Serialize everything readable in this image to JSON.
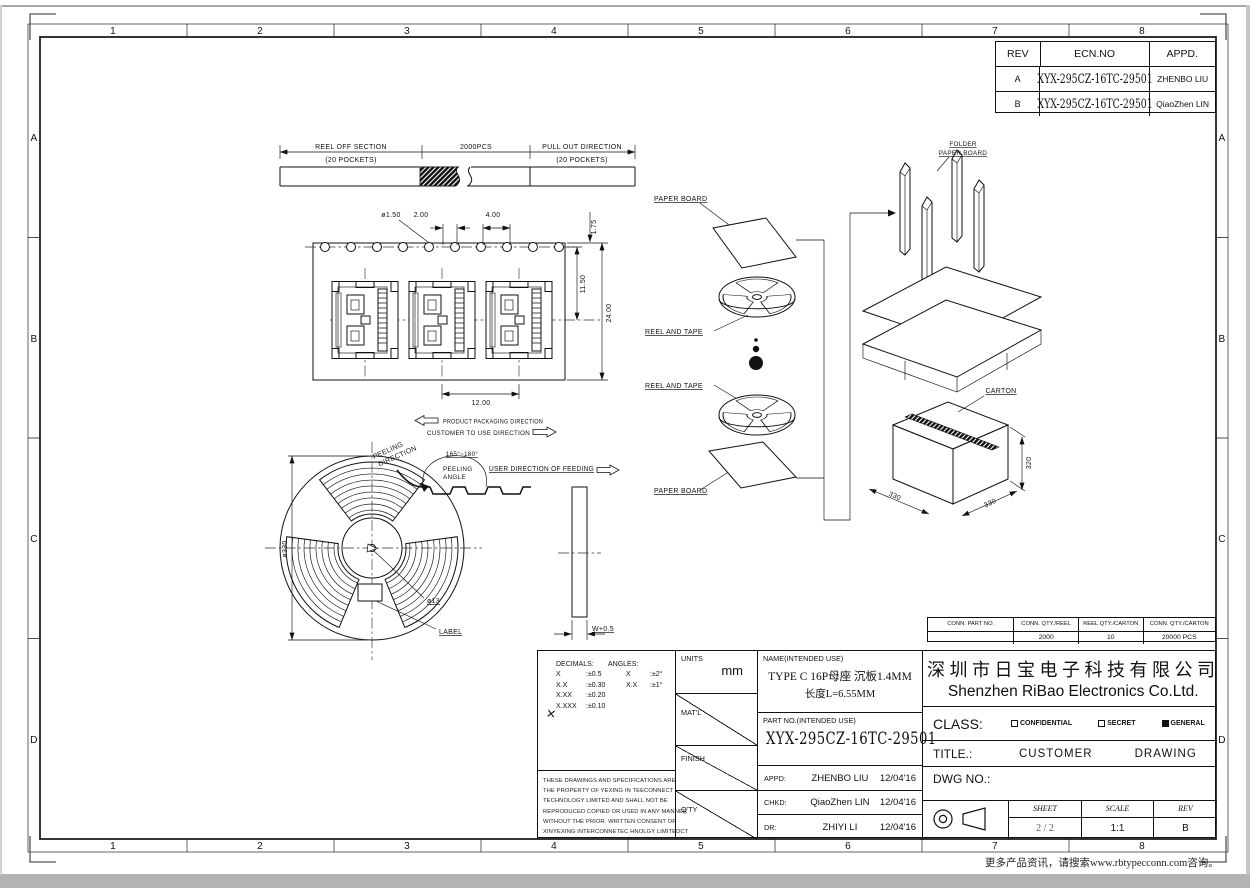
{
  "zones": {
    "top": [
      "1",
      "2",
      "3",
      "4",
      "5",
      "6",
      "7",
      "8"
    ],
    "bottom": [
      "1",
      "2",
      "3",
      "4",
      "5",
      "6",
      "7",
      "8"
    ],
    "left": [
      "A",
      "B",
      "C",
      "D"
    ],
    "right": [
      "A",
      "B",
      "C",
      "D"
    ]
  },
  "rev_table": {
    "h_rev": "REV",
    "h_ecn": "ECN.NO",
    "h_appd": "APPD.",
    "rows": [
      {
        "rev": "A",
        "ecn": "XYX-295CZ-16TC-29501",
        "appd": "ZHENBO LIU"
      },
      {
        "rev": "B",
        "ecn": "XYX-295CZ-16TC-29501",
        "appd": "QiaoZhen LIN"
      }
    ]
  },
  "strip": {
    "left_title": "REEL OFF SECTION",
    "left_sub": "(20 POCKETS)",
    "mid": "2000PCS",
    "right_title": "PULL OUT DIRECTION",
    "right_sub": "(20 POCKETS)"
  },
  "tape": {
    "dia_hole": "ø1.50",
    "dim_2": "2.00",
    "dim_4": "4.00",
    "dim_175": "1.75",
    "dim_1150": "11.50",
    "dim_24": "24.00",
    "dim_12": "12.00",
    "pack_dir": "PRODUCT PACKAGING DIRECTION",
    "use_dir": "CUSTOMER TO USE DIRECTION"
  },
  "reel": {
    "peel1": "PEELING",
    "peel2": "DIRECTION",
    "angle_range": "165°~180°",
    "angle1": "PEELING",
    "angle2": "ANGLE",
    "feed": "USER DIRECTION OF FEEDING",
    "dia": "ø330",
    "hub_dia": "ø13",
    "label": "LABEL",
    "width": "W+0.5"
  },
  "flow": {
    "paper_board_top": "PAPER BOARD",
    "reel_tape_1": "REEL AND TAPE",
    "reel_tape_2": "REEL AND TAPE",
    "paper_board_bottom": "PAPER BOARD",
    "folder1": "FOLDER",
    "folder2": "PAPER BOARD",
    "carton": "CARTON",
    "dim_left": "330",
    "dim_right": "330",
    "dim_height": "320"
  },
  "conn_table": {
    "h1": "CONN. PART NO.",
    "h2": "CONN. QTY./REEL",
    "h3": "REEL QTY./CARTON",
    "h4": "CONN. QTY./CARTON",
    "v1": "",
    "v2": "2000",
    "v3": "10",
    "v4": "20000 PCS"
  },
  "tb": {
    "decimals": "DECIMALS:",
    "angles": "ANGLES:",
    "tol": [
      {
        "a": "X",
        "b": ":±0.5",
        "c": "X",
        "d": ":±2°"
      },
      {
        "a": "X.X",
        "b": ":±0.30",
        "c": "X.X",
        "d": ":±1°"
      },
      {
        "a": "X.XX",
        "b": ":±0.20",
        "c": "",
        "d": ""
      },
      {
        "a": "X.XXX",
        "b": ":±0.10",
        "c": "",
        "d": ""
      }
    ],
    "check": "✕",
    "units_label": "UNITS",
    "units_value": "mm",
    "matl": "MAT'L",
    "finish": "FINISH",
    "qty": "Q'TY",
    "name_label": "NAME(INTENDED USE)",
    "name1": "TYPE C 16P母座 沉板1.4MM",
    "name2": "长度L=6.55MM",
    "part_label": "PART NO.(INTENDED USE)",
    "part_no": "XYX-295CZ-16TC-29501",
    "appd_label": "APPD:",
    "appd_name": "ZHENBO LIU",
    "appd_date": "12/04'16",
    "chkd_label": "CHKD:",
    "chkd_name": "QiaoZhen LIN",
    "chkd_date": "12/04'16",
    "dr_label": "DR:",
    "dr_name": "ZHIYI LI",
    "dr_date": "12/04'16",
    "legal": [
      "THESE DRAWINGS AND SPECIFICATIONS ARE",
      "THE PROPERTY OF YEXING IN TEECONNECT",
      "TECHNOLOGY LIMITED AND SHALL NOT BE",
      "REPRODUCED COPIED OR USED IN ANY MANNER",
      "WITHOUT THE PRIOR. WRITTEN CONSENT OF",
      "XINYEXING INTERCONNETEC HNOLGY LIMITEDCT"
    ],
    "company_cn": "深圳市日宝电子科技有限公司",
    "company_en": "Shenzhen RiBao Electronics Co.Ltd.",
    "class_label": "CLASS:",
    "class_conf": "CONFIDENTIAL",
    "class_secret": "SECRET",
    "class_general": "GENERAL",
    "title_label": "TITLE.:",
    "title_word1": "CUSTOMER",
    "title_word2": "DRAWING",
    "dwg_label": "DWG NO.:",
    "sheet_label": "SHEET",
    "sheet_value": "2 / 2",
    "scale_label": "SCALE",
    "scale_value": "1:1",
    "rev_label": "REV",
    "rev_value": "B"
  },
  "footer": {
    "note": "更多产品资讯，请搜索www.rbtypecconn.com咨询。"
  }
}
